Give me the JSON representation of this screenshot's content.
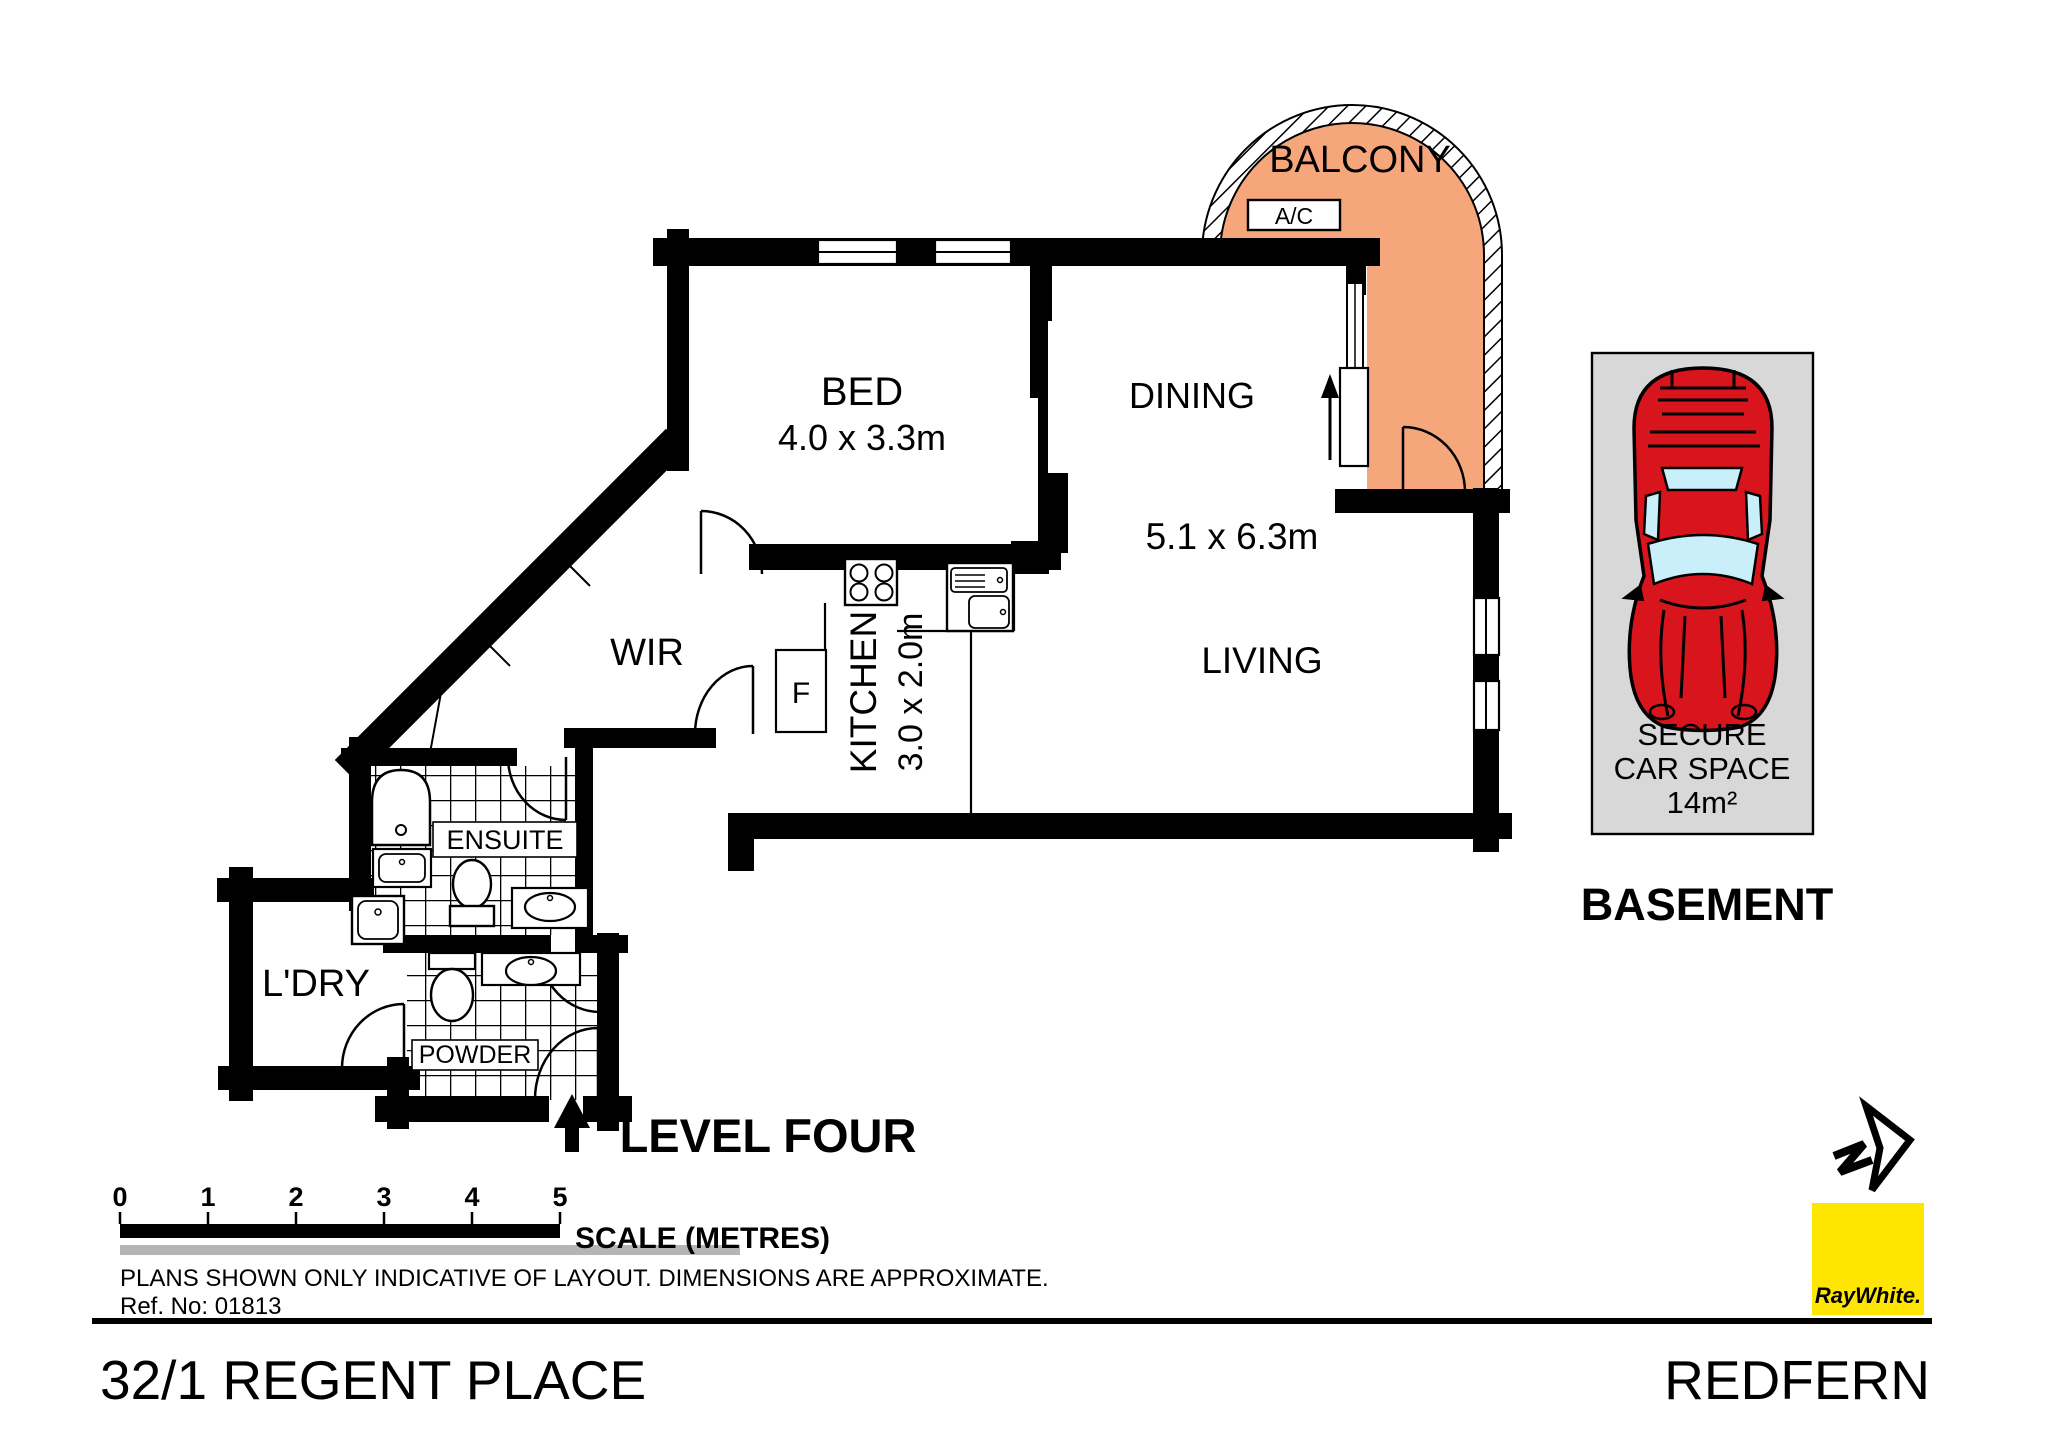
{
  "page": {
    "address": "32/1 REGENT PLACE",
    "suburb": "REDFERN",
    "level_label": "LEVEL FOUR",
    "disclaimer": "PLANS SHOWN ONLY INDICATIVE OF LAYOUT.  DIMENSIONS ARE APPROXIMATE.",
    "ref_no": "Ref. No: 01813"
  },
  "rooms": {
    "balcony": {
      "label": "BALCONY"
    },
    "ac": {
      "label": "A/C"
    },
    "bed": {
      "label": "BED",
      "dims": "4.0 x 3.3m"
    },
    "dining": {
      "label": "DINING"
    },
    "living": {
      "label": "LIVING",
      "dims": "5.1 x 6.3m"
    },
    "kitchen": {
      "label": "KITCHEN",
      "dims": "3.0 x 2.0m"
    },
    "wir": {
      "label": "WIR"
    },
    "fridge": {
      "label": "F"
    },
    "ensuite": {
      "label": "ENSUITE"
    },
    "laundry": {
      "label": "L'DRY"
    },
    "powder": {
      "label": "POWDER"
    }
  },
  "car_space": {
    "line1": "SECURE",
    "line2": "CAR SPACE",
    "line3": "14m²",
    "location": "BASEMENT"
  },
  "scale_bar": {
    "ticks": [
      "0",
      "1",
      "2",
      "3",
      "4",
      "5"
    ],
    "label": "SCALE (METRES)"
  },
  "logo": {
    "brand": "RayWhite."
  },
  "colors": {
    "balcony_fill": "#F5A67B",
    "car_red": "#D8151D",
    "car_glass": "#C9EFFA",
    "carspace_gray": "#D8D8D8",
    "logo_yellow": "#FFE600",
    "logo_text": "#3E3E47",
    "scale_gray": "#B5B5B5"
  }
}
